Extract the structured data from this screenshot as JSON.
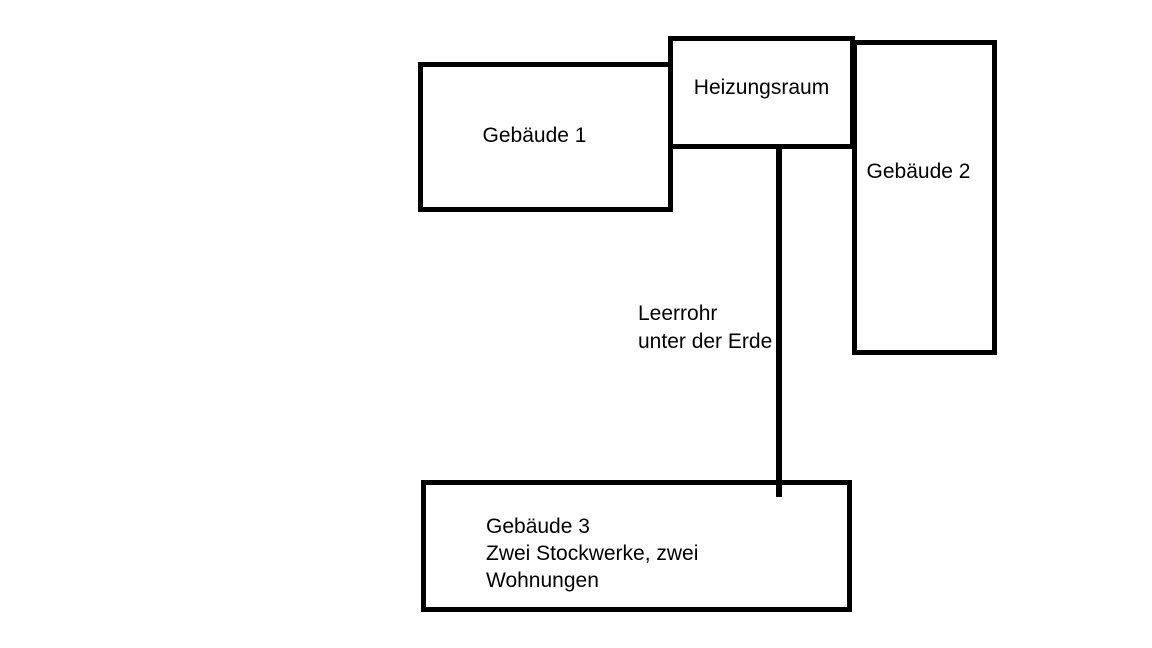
{
  "page": {
    "background_color": "#ffffff"
  },
  "diagram": {
    "stroke_color": "#000000",
    "text_color": "#000000",
    "boxes": {
      "gebaeude1": {
        "label": "Gebäude 1"
      },
      "heizungsraum": {
        "label": "Heizungsraum"
      },
      "gebaeude2": {
        "label": "Gebäude 2"
      },
      "gebaeude3": {
        "lines": [
          "Gebäude 3",
          "Zwei Stockwerke, zwei",
          "Wohnungen"
        ]
      }
    },
    "connector": {
      "label_lines": [
        "Leerrohr",
        "unter der Erde"
      ]
    }
  }
}
